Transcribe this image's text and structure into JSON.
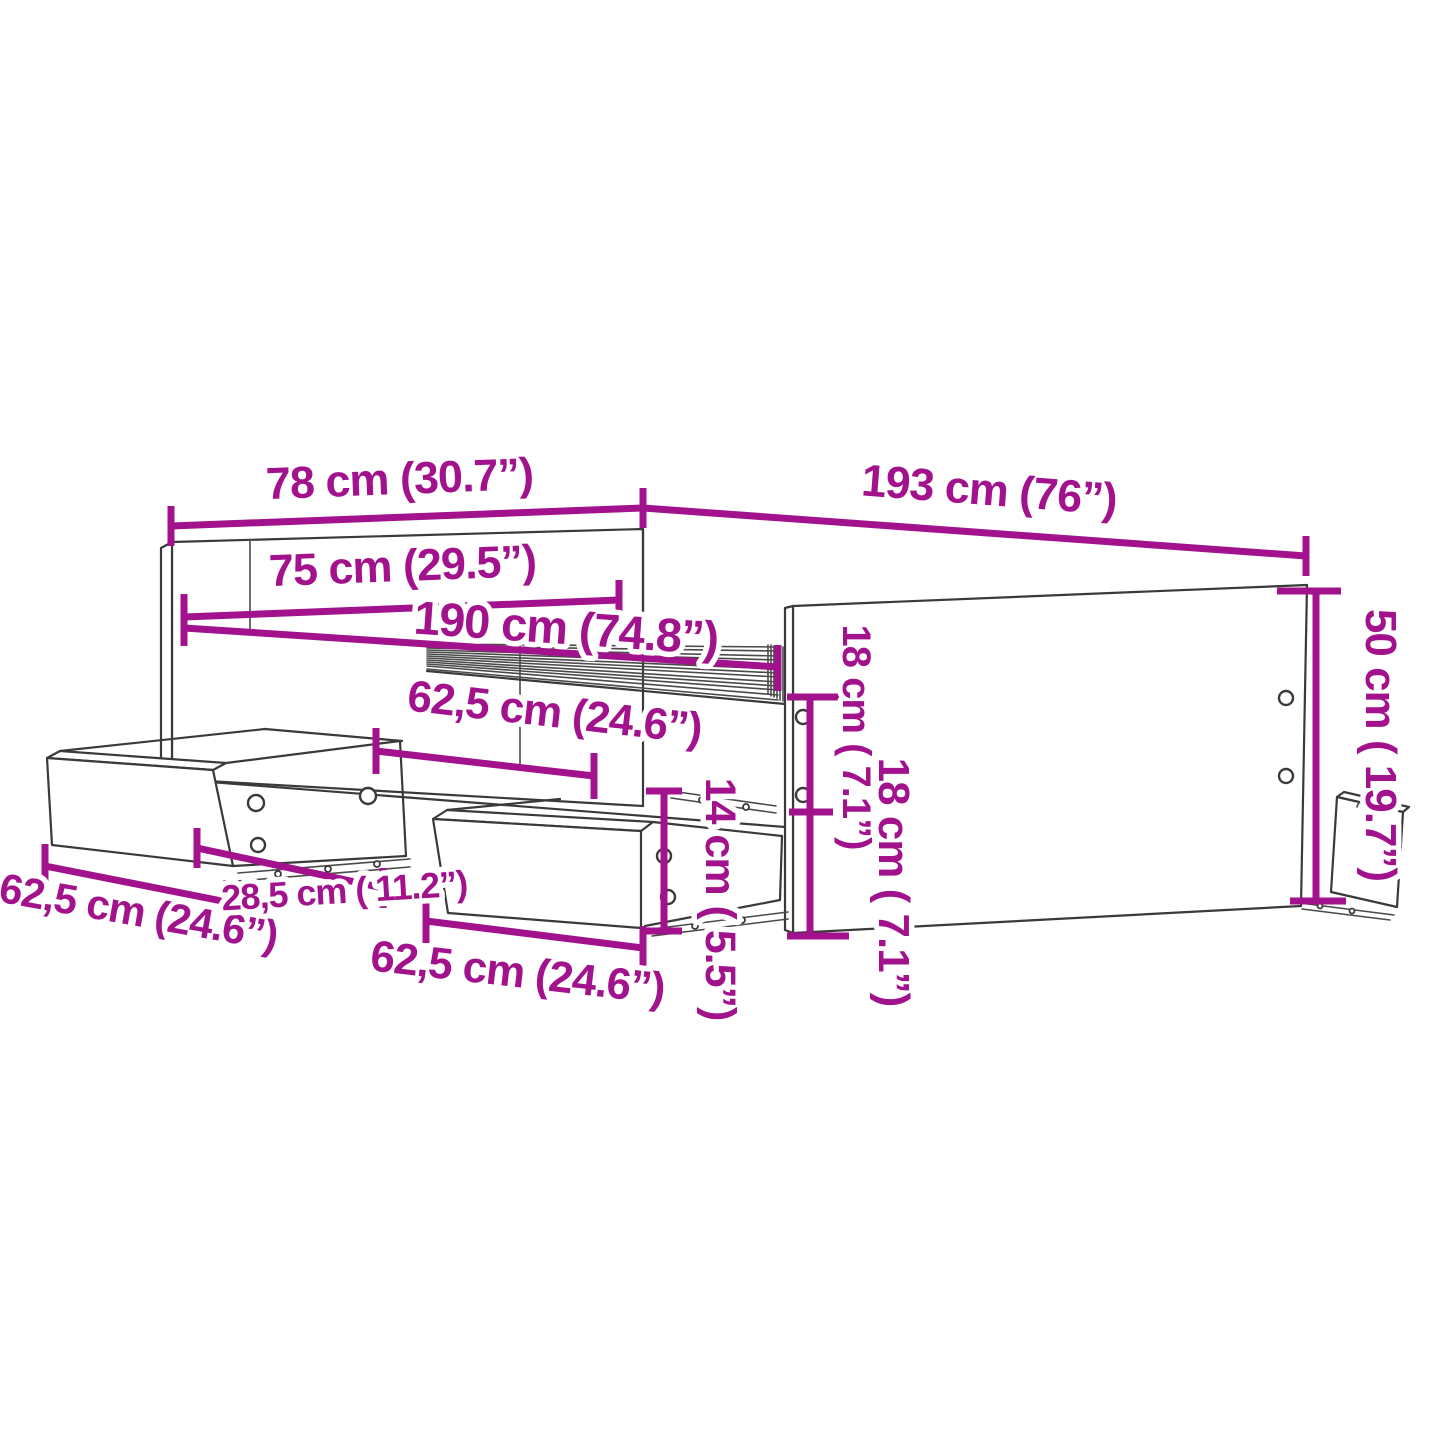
{
  "meta": {
    "background": "#FFFFFF",
    "accent_color": "#A2128C",
    "ink_color": "#3A3A3A",
    "diagram_kind": "furniture-dimension-line-drawing",
    "subject": "bed frame with headboard, footboard and storage drawers"
  },
  "dimensions": [
    {
      "id": "headboard-width",
      "cm": "78",
      "inches": "30.7",
      "label": "78 cm (30.7”)"
    },
    {
      "id": "bed-length",
      "cm": "193",
      "inches": "76",
      "label": "193 cm (76”)"
    },
    {
      "id": "inner-width",
      "cm": "75",
      "inches": "29.5",
      "label": "75 cm (29.5”)"
    },
    {
      "id": "inner-length",
      "cm": "190",
      "inches": "74.8",
      "label": "190 cm (74.8”)"
    },
    {
      "id": "drawer-bay-width",
      "cm": "62,5",
      "inches": "24.6",
      "label": "62,5 cm (24.6”)"
    },
    {
      "id": "rail-height-upper",
      "cm": "18",
      "inches": "7.1",
      "label": "18 cm ( 7.1”)"
    },
    {
      "id": "footboard-height",
      "cm": "50",
      "inches": "19.7",
      "label": "50 cm ( 19.7”)"
    },
    {
      "id": "drawer-left-width",
      "cm": "62,5",
      "inches": "24.6",
      "label": "62,5 cm (24.6”)"
    },
    {
      "id": "drawer-depth",
      "cm": "28,5",
      "inches": "11.2",
      "label": "28,5 cm ( 11.2”)"
    },
    {
      "id": "drawer-middle-width",
      "cm": "62,5",
      "inches": "24.6",
      "label": "62,5 cm (24.6”)"
    },
    {
      "id": "drawer-front-height",
      "cm": "14",
      "inches": "5.5",
      "label": "14 cm ( 5.5”)"
    },
    {
      "id": "rail-height-lower",
      "cm": "18",
      "inches": "7.1",
      "label": "18 cm ( 7.1”)"
    }
  ]
}
